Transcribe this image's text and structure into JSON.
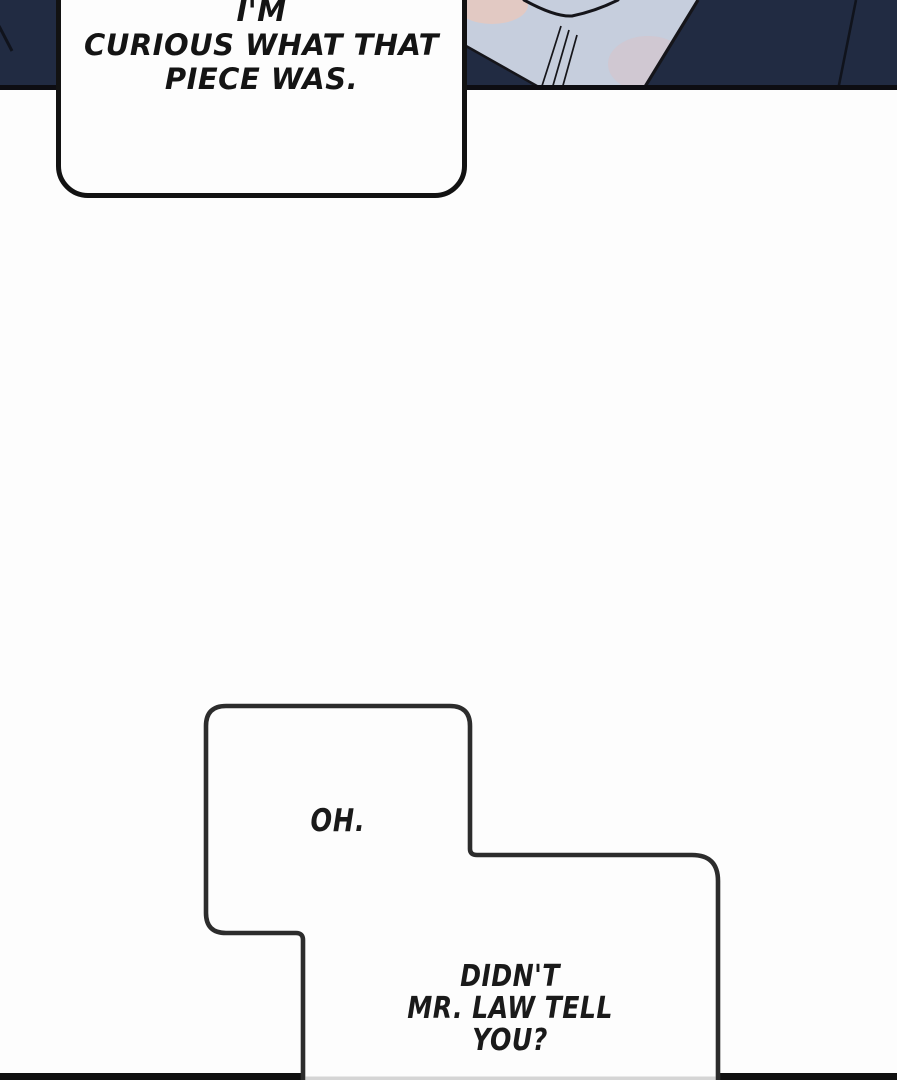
{
  "page": {
    "background_color": "#fdfdfd",
    "type": "comic-page"
  },
  "top_panel": {
    "background_color": "#212b42",
    "border_color": "#0d0d12",
    "art": {
      "description": "character torso, dark navy suit jacket over light shirt",
      "suit_color": "#212b42",
      "shirt_color": "#c6cedd",
      "skin_color": "#e2c9c3",
      "blush_color": "#d9c2c7",
      "line_color": "#15151a"
    }
  },
  "speech_bubbles": [
    {
      "id": "bubble-top",
      "text": "I'M\nCURIOUS WHAT THAT\nPIECE WAS.",
      "fill_color": "#fdfdfd",
      "border_color": "#121212"
    },
    {
      "id": "bubble-oh",
      "text": "OH.",
      "fill_color": "#fdfdfd",
      "border_color": "#2c2c2c"
    },
    {
      "id": "bubble-law",
      "text": "DIDN'T\nMR. LAW TELL\nYOU?",
      "fill_color": "#fdfdfd",
      "border_color": "#2c2c2c"
    }
  ],
  "bottom_divider": {
    "color": "#101010",
    "inner_shadow_color": "#d5d5d5"
  }
}
